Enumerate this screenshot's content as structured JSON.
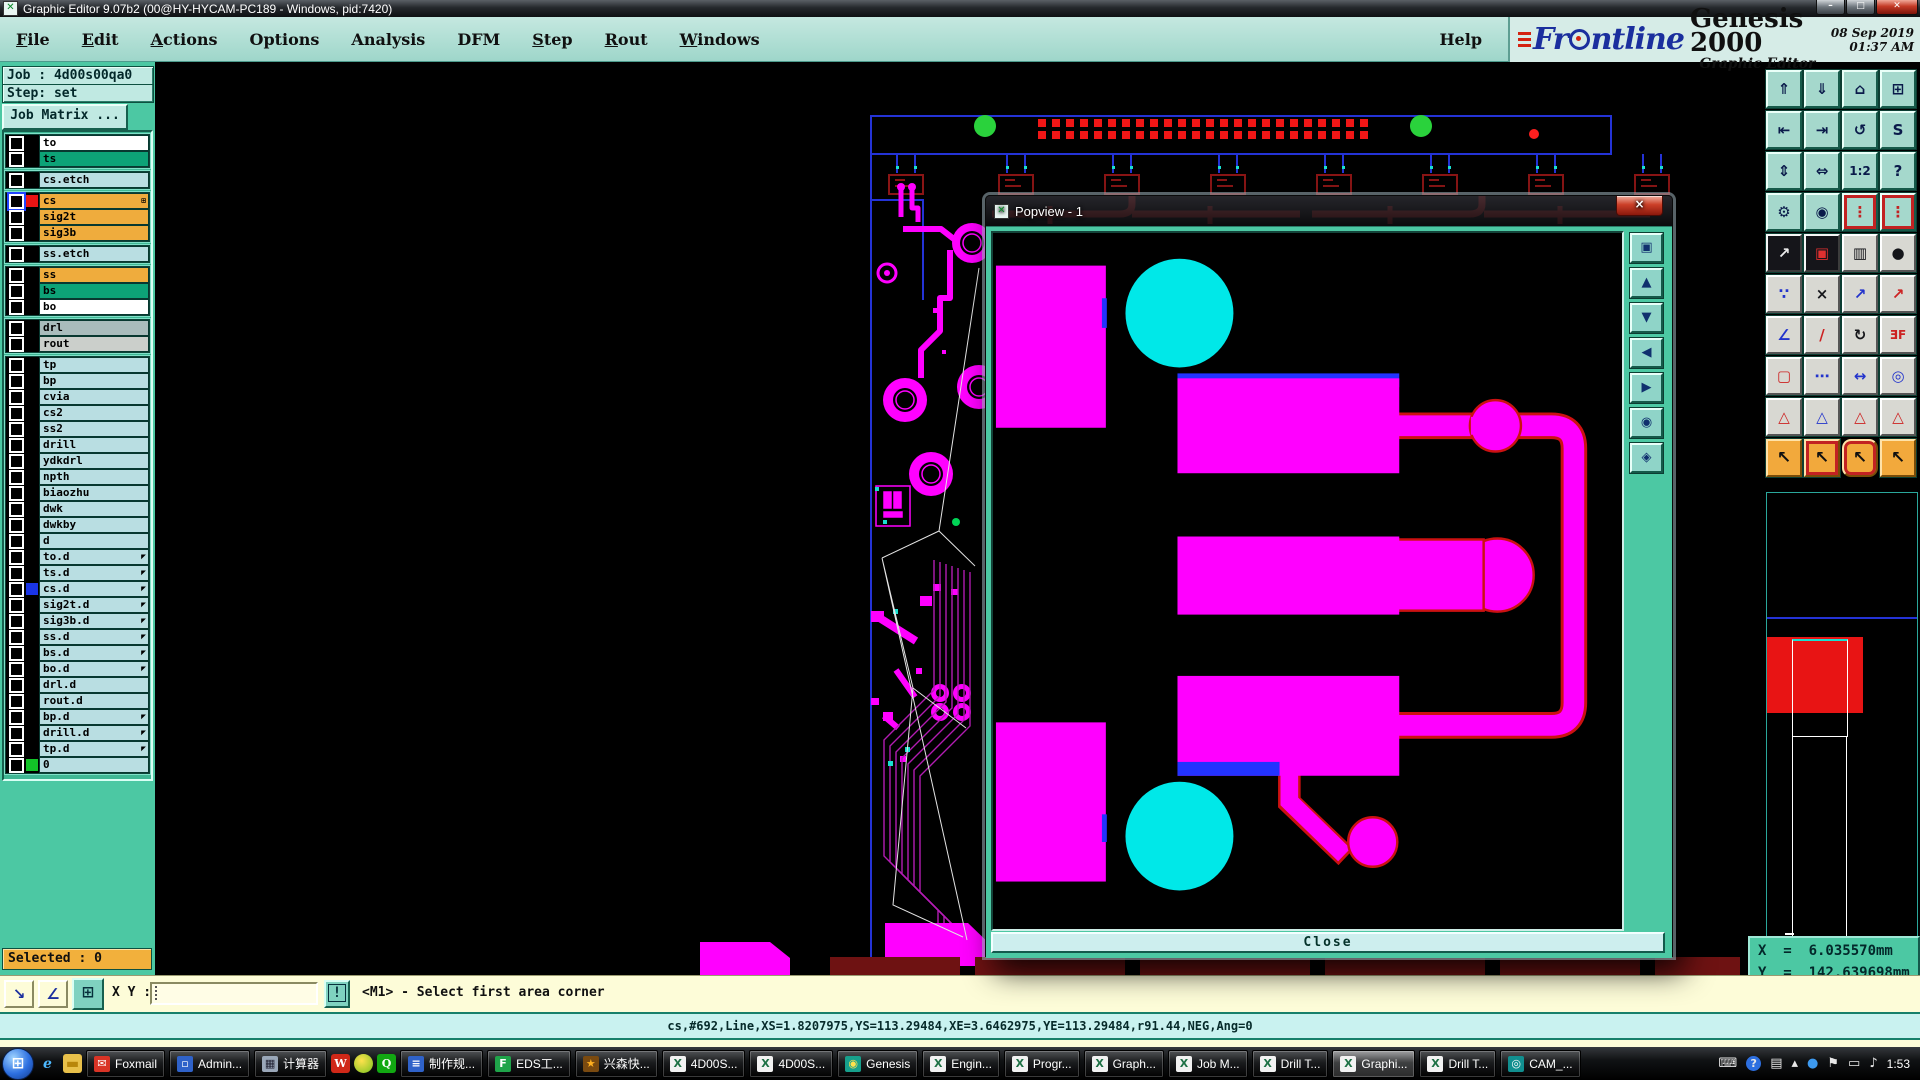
{
  "titlebar": {
    "title": "Graphic Editor 9.07b2 (00@HY-HYCAM-PC189 - Windows, pid:7420)"
  },
  "menubar": {
    "items": [
      {
        "label": "File",
        "underline": 0
      },
      {
        "label": "Edit",
        "underline": 0
      },
      {
        "label": "Actions",
        "underline": 0
      },
      {
        "label": "Options",
        "underline": null
      },
      {
        "label": "Analysis",
        "underline": null
      },
      {
        "label": "DFM",
        "underline": null
      },
      {
        "label": "Step",
        "underline": 0
      },
      {
        "label": "Rout",
        "underline": 0
      },
      {
        "label": "Windows",
        "underline": 0
      }
    ],
    "help": "Help"
  },
  "brand": {
    "name_left": "Fr",
    "name_right": "ntline",
    "product": "Genesis 2000",
    "subtitle": "Graphic Editor",
    "datetime": "08 Sep 2019\n01:37 AM"
  },
  "sidebar": {
    "job_label": "Job : 4d00s00qa0",
    "step_label": "Step: set",
    "job_matrix_label": "Job Matrix ...",
    "selected_label": "Selected : 0",
    "layer_groups": [
      [
        {
          "n": "to",
          "c": "w"
        },
        {
          "n": "ts",
          "c": "g"
        }
      ],
      [
        {
          "n": "cs.etch",
          "c": "p"
        }
      ],
      [
        {
          "n": "cs",
          "c": "o",
          "s": "#e81414",
          "act": true,
          "plus": true
        },
        {
          "n": "sig2t",
          "c": "o"
        },
        {
          "n": "sig3b",
          "c": "o"
        }
      ],
      [
        {
          "n": "ss.etch",
          "c": "p"
        }
      ],
      [
        {
          "n": "ss",
          "c": "o"
        },
        {
          "n": "bs",
          "c": "g"
        },
        {
          "n": "bo",
          "c": "w"
        }
      ],
      [
        {
          "n": "drl",
          "c": "dg"
        },
        {
          "n": "rout",
          "c": "lg"
        }
      ],
      [
        {
          "n": "tp",
          "c": "p"
        },
        {
          "n": "bp",
          "c": "p"
        },
        {
          "n": "cvia",
          "c": "p"
        },
        {
          "n": "cs2",
          "c": "p"
        },
        {
          "n": "ss2",
          "c": "p"
        },
        {
          "n": "drill",
          "c": "p"
        },
        {
          "n": "ydkdrl",
          "c": "p"
        },
        {
          "n": "npth",
          "c": "p"
        },
        {
          "n": "biaozhu",
          "c": "p"
        },
        {
          "n": "dwk",
          "c": "p"
        },
        {
          "n": "dwkby",
          "c": "p"
        },
        {
          "n": "d",
          "c": "p"
        },
        {
          "n": "to.d",
          "c": "p",
          "a": true
        },
        {
          "n": "ts.d",
          "c": "p",
          "a": true
        },
        {
          "n": "cs.d",
          "c": "p",
          "s": "#1a35e8",
          "a": true
        },
        {
          "n": "sig2t.d",
          "c": "p",
          "a": true
        },
        {
          "n": "sig3b.d",
          "c": "p",
          "a": true
        },
        {
          "n": "ss.d",
          "c": "p",
          "a": true
        },
        {
          "n": "bs.d",
          "c": "p",
          "a": true
        },
        {
          "n": "bo.d",
          "c": "p",
          "a": true
        },
        {
          "n": "drl.d",
          "c": "p"
        },
        {
          "n": "rout.d",
          "c": "p"
        },
        {
          "n": "bp.d",
          "c": "p",
          "a": true
        },
        {
          "n": "drill.d",
          "c": "p",
          "a": true
        },
        {
          "n": "tp.d",
          "c": "p",
          "a": true
        },
        {
          "n": "0",
          "c": "p",
          "s": "#12c428"
        }
      ]
    ]
  },
  "right_toolbar": {
    "buttons": [
      {
        "name": "zoom-page-up",
        "g": "⇑",
        "c": "t"
      },
      {
        "name": "zoom-page-down",
        "g": "⇓",
        "c": "t"
      },
      {
        "name": "home-view",
        "g": "⌂",
        "c": "t"
      },
      {
        "name": "split-window-xy",
        "g": "⊞",
        "c": "t"
      },
      {
        "name": "view-previous",
        "g": "⇤",
        "c": "t"
      },
      {
        "name": "view-next",
        "g": "⇥",
        "c": "t"
      },
      {
        "name": "undo-view",
        "g": "↺",
        "c": "t"
      },
      {
        "name": "serpentine-view",
        "g": "S",
        "c": "t"
      },
      {
        "name": "zoom-extents",
        "g": "⇕",
        "c": "t"
      },
      {
        "name": "pan-view",
        "g": "⇔",
        "c": "t"
      },
      {
        "name": "zoom-1-2",
        "g": "1:2",
        "c": "t sm"
      },
      {
        "name": "zoom-help",
        "g": "?",
        "c": "t"
      },
      {
        "name": "setup-tools",
        "g": "⚙",
        "c": "t"
      },
      {
        "name": "snap-target",
        "g": "◉",
        "c": "t"
      },
      {
        "name": "layer-stoplight-a",
        "g": "⋮",
        "c": "t rf",
        "col": "#c22222"
      },
      {
        "name": "layer-stoplight-b",
        "g": "⋮",
        "c": "t rf",
        "col": "#c22222"
      },
      {
        "name": "select-pad-move",
        "g": "↗",
        "c": "d"
      },
      {
        "name": "swap-frames",
        "g": "▣",
        "c": "d",
        "col": "#e03030"
      },
      {
        "name": "measure-ruler",
        "g": "▥",
        "c": "g"
      },
      {
        "name": "pad-capture",
        "g": "●",
        "c": "g"
      },
      {
        "name": "net-nodes",
        "g": "∵",
        "c": "g",
        "col": "#2233cc"
      },
      {
        "name": "delete-mode",
        "g": "×",
        "c": "g"
      },
      {
        "name": "move-origin",
        "g": "↗",
        "c": "g",
        "col": "#2233cc"
      },
      {
        "name": "copy-origin",
        "g": "↗",
        "c": "g",
        "col": "#cc2222"
      },
      {
        "name": "angle-mode",
        "g": "∠",
        "c": "g",
        "col": "#2233cc"
      },
      {
        "name": "line-mode",
        "g": "/",
        "c": "g",
        "col": "#cc2222"
      },
      {
        "name": "rotate-mode",
        "g": "↻",
        "c": "g"
      },
      {
        "name": "mirror-mode",
        "g": "ƎF",
        "c": "g sm",
        "col": "#cc2222"
      },
      {
        "name": "frame-pad",
        "g": "▢",
        "c": "g",
        "col": "#cc2222"
      },
      {
        "name": "stretch-line",
        "g": "⋯",
        "c": "g",
        "col": "#2233cc"
      },
      {
        "name": "dimension-mode",
        "g": "↔",
        "c": "g",
        "col": "#2233cc"
      },
      {
        "name": "circle-overlap",
        "g": "◎",
        "c": "g",
        "col": "#2233cc"
      },
      {
        "name": "peak-marker-a",
        "g": "△",
        "c": "g",
        "col": "#cc2222"
      },
      {
        "name": "peak-marker-b",
        "g": "△",
        "c": "g",
        "col": "#2233cc"
      },
      {
        "name": "peak-marker-c",
        "g": "△",
        "c": "g",
        "col": "#cc2222"
      },
      {
        "name": "peak-marker-d",
        "g": "△",
        "c": "g",
        "col": "#cc2222"
      },
      {
        "name": "select-single",
        "g": "↖",
        "c": "o"
      },
      {
        "name": "select-frame",
        "g": "↖",
        "c": "o rf"
      },
      {
        "name": "select-polygon",
        "g": "↖",
        "c": "o rr"
      },
      {
        "name": "select-chain",
        "g": "↖",
        "c": "o"
      }
    ]
  },
  "popview": {
    "title": "Popview - 1",
    "close_x": "×",
    "close_label": "Close",
    "tools": [
      {
        "name": "popview-windows-icon",
        "g": "▣"
      },
      {
        "name": "pan-up-icon",
        "g": "▲"
      },
      {
        "name": "pan-down-icon",
        "g": "▼"
      },
      {
        "name": "pan-left-icon",
        "g": "◀"
      },
      {
        "name": "pan-right-icon",
        "g": "▶"
      },
      {
        "name": "zoom-in-icon",
        "g": "◉"
      },
      {
        "name": "zoom-out-icon",
        "g": "◈"
      }
    ]
  },
  "statusbar": {
    "corner_btn_1": "↘",
    "corner_btn_2": "∠",
    "grid_btn": "⊞",
    "xy_label": "X Y :",
    "xy_value": "",
    "bang": "!",
    "message": "<M1> - Select first area corner"
  },
  "command_line": "cs,#692,Line,XS=1.8207975,YS=113.29484,XE=3.6462975,YE=113.29484,r91.44,NEG,Ang=0",
  "coords": {
    "x_line": "X  =  6.035570mm",
    "y_line": "Y  =  142.639698mm",
    "units": "MM"
  },
  "taskbar": {
    "quick": [
      {
        "name": "ie-icon",
        "g": "e",
        "bg": "transparent",
        "fg": "#4db8ff"
      },
      {
        "name": "folder-icon",
        "g": "▬",
        "bg": "#e8c04a",
        "fg": "#b8860b"
      }
    ],
    "items": [
      {
        "label": "Foxmail",
        "icon": "foxmail",
        "g": "✉",
        "bg": "#d93426",
        "fg": "#fff"
      },
      {
        "label": "Admin...",
        "icon": "floppy",
        "g": "▫",
        "bg": "#2f62c9",
        "fg": "#fff"
      },
      {
        "label": "计算器",
        "icon": "calculator",
        "g": "▦",
        "bg": "#9aa7b8",
        "fg": "#223"
      },
      {
        "label": "",
        "icon": "wps",
        "g": "W",
        "bg": "#d02818",
        "fg": "#fff"
      },
      {
        "label": "",
        "icon": "citrus",
        "g": "",
        "bg": "radial",
        "fg": "#fff"
      },
      {
        "label": "",
        "icon": "green-app",
        "g": "Q",
        "bg": "#12a812",
        "fg": "#fff"
      },
      {
        "label": "制作规...",
        "icon": "doc-blue",
        "g": "≡",
        "bg": "#2f62c9",
        "fg": "#fff"
      },
      {
        "label": "EDS工...",
        "icon": "green-f",
        "g": "F",
        "bg": "#1fa44a",
        "fg": "#fff"
      },
      {
        "label": "兴森快...",
        "icon": "star-orange",
        "g": "★",
        "bg": "#7a4a10",
        "fg": "#ffb020"
      },
      {
        "label": "4D00S...",
        "icon": "excel",
        "g": "X",
        "bg": "#f2f2f2",
        "fg": "#1e7145"
      },
      {
        "label": "4D00S...",
        "icon": "excel",
        "g": "X",
        "bg": "#f2f2f2",
        "fg": "#1e7145"
      },
      {
        "label": "Genesis",
        "icon": "genesis",
        "g": "◉",
        "bg": "#17a08c",
        "fg": "#ffe14d"
      },
      {
        "label": "Engin...",
        "icon": "xapp",
        "g": "X",
        "bg": "#f2f2f2",
        "fg": "#1e7145"
      },
      {
        "label": "Progr...",
        "icon": "xapp",
        "g": "X",
        "bg": "#f2f2f2",
        "fg": "#1e7145"
      },
      {
        "label": "Graph...",
        "icon": "xapp",
        "g": "X",
        "bg": "#f2f2f2",
        "fg": "#1e7145"
      },
      {
        "label": "Job M...",
        "icon": "xapp",
        "g": "X",
        "bg": "#f2f2f2",
        "fg": "#1e7145"
      },
      {
        "label": "Drill T...",
        "icon": "xapp",
        "g": "X",
        "bg": "#f2f2f2",
        "fg": "#1e7145"
      },
      {
        "label": "Graphi...",
        "icon": "xapp",
        "g": "X",
        "bg": "#f2f2f2",
        "fg": "#1e7145",
        "active": true
      },
      {
        "label": "Drill T...",
        "icon": "xapp",
        "g": "X",
        "bg": "#f2f2f2",
        "fg": "#1e7145"
      },
      {
        "label": "CAM_...",
        "icon": "cam",
        "g": "◎",
        "bg": "#118f8f",
        "fg": "#fff"
      }
    ],
    "tray": [
      {
        "name": "keyboard-tray-icon",
        "g": "⌨",
        "cls": ""
      },
      {
        "name": "help-tray-icon",
        "g": "?",
        "cls": "qmark"
      },
      {
        "name": "show-desktop-icon",
        "g": "▤",
        "cls": ""
      },
      {
        "name": "show-hidden-icon",
        "g": "▴",
        "cls": ""
      },
      {
        "name": "thunder-tray-icon",
        "g": "●",
        "cls": "",
        "col": "#3d9af0"
      },
      {
        "name": "action-center-icon",
        "g": "⚑",
        "cls": ""
      },
      {
        "name": "network-tray-icon",
        "g": "▭",
        "cls": ""
      },
      {
        "name": "volume-tray-icon",
        "g": "♪",
        "cls": ""
      }
    ],
    "time": "1:53"
  }
}
